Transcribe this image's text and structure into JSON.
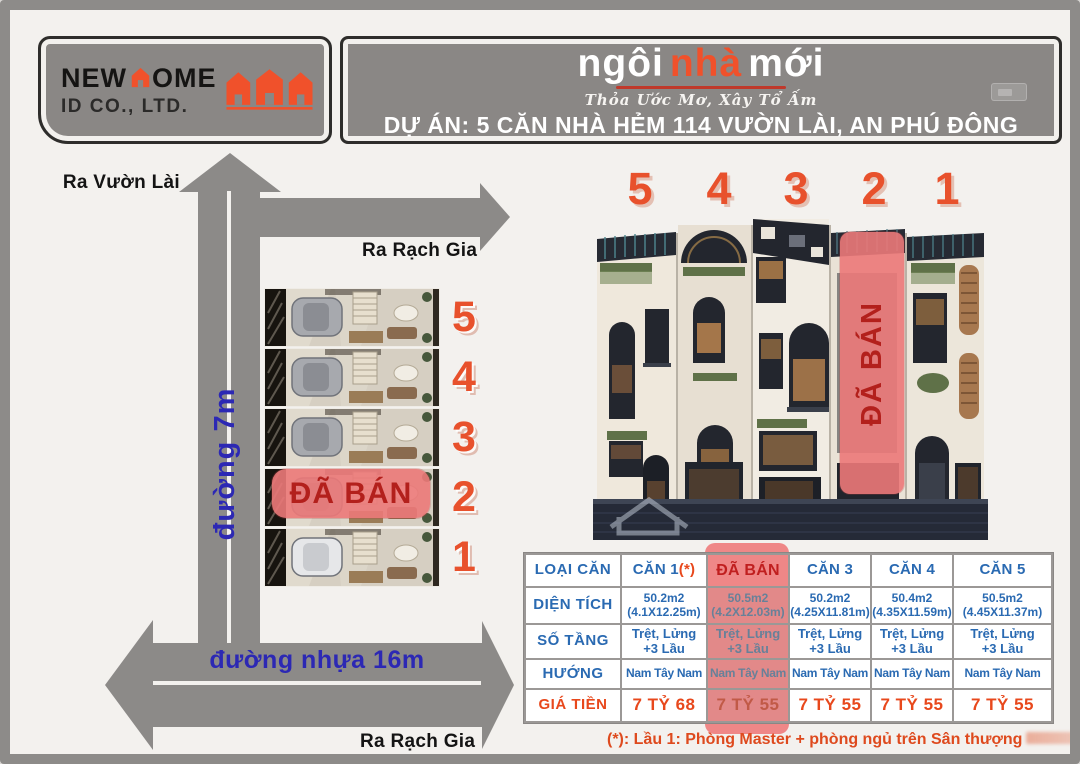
{
  "logo": {
    "brand_pre": "NEW",
    "brand_post": "OME",
    "brand_sub": "ID CO., LTD.",
    "house_icon_color": "#f0512b"
  },
  "header": {
    "title_pre": "ngôi",
    "title_mid": "nhà",
    "title_post": "mới",
    "tagline": "Thỏa Ước Mơ, Xây Tổ Ấm",
    "project_line": "DỰ ÁN:  5 CĂN NHÀ HẺM 114 VƯỜN LÀI, AN PHÚ ĐÔNG"
  },
  "map": {
    "exit_top": "Ra Vườn Lài",
    "exit_right": "Ra Rạch Gia",
    "exit_bottom": "Ra Rạch Gia",
    "road_vertical": "đường 7m",
    "road_horizontal": "đường nhựa 16m",
    "sold_label": "ĐÃ BÁN",
    "plans": [
      {
        "num": "5"
      },
      {
        "num": "4"
      },
      {
        "num": "3"
      },
      {
        "num": "2",
        "sold": true
      },
      {
        "num": "1"
      }
    ]
  },
  "render": {
    "unit_numbers": [
      "5",
      "4",
      "3",
      "2",
      "1"
    ],
    "sold_label": "ĐÃ BÁN"
  },
  "table": {
    "corner_label": "LOẠI CĂN",
    "col_headers": [
      "CĂN 1",
      "ĐÃ BÁN",
      "CĂN 3",
      "CĂN 4",
      "CĂN 5"
    ],
    "can1_suffix": "(*)",
    "sold_col_index": 1,
    "rows": [
      {
        "key": "dientich",
        "label": "DIỆN TÍCH",
        "cells": [
          [
            "50.2m2",
            "(4.1X12.25m)"
          ],
          [
            "50.5m2",
            "(4.2X12.03m)"
          ],
          [
            "50.2m2",
            "(4.25X11.81m)"
          ],
          [
            "50.4m2",
            "(4.35X11.59m)"
          ],
          [
            "50.5m2",
            "(4.45X11.37m)"
          ]
        ]
      },
      {
        "key": "sotang",
        "label": "SỐ TẦNG",
        "cells": [
          [
            "Trệt, Lửng",
            "+3 Lầu"
          ],
          [
            "Trệt, Lửng",
            "+3 Lầu"
          ],
          [
            "Trệt, Lửng",
            "+3 Lầu"
          ],
          [
            "Trệt, Lửng",
            "+3 Lầu"
          ],
          [
            "Trệt, Lửng",
            "+3 Lầu"
          ]
        ]
      },
      {
        "key": "huong",
        "label": "HƯỚNG",
        "cells": [
          [
            "Nam Tây Nam"
          ],
          [
            "Nam Tây Nam"
          ],
          [
            "Nam Tây Nam"
          ],
          [
            "Nam Tây Nam"
          ],
          [
            "Nam Tây Nam"
          ]
        ]
      },
      {
        "key": "gia",
        "label": "GIÁ TIỀN",
        "cells": [
          [
            "7 TỶ 68"
          ],
          [
            "7 TỶ 55"
          ],
          [
            "7 TỶ 55"
          ],
          [
            "7 TỶ 55"
          ],
          [
            "7 TỶ 55"
          ]
        ]
      }
    ]
  },
  "footnote": "(*): Lầu 1: Phòng Master + phòng ngủ trên Sân thượng",
  "colors": {
    "accent_orange": "#f0512b",
    "number_orange": "#e8512c",
    "road_gray": "#8c8a88",
    "road_text_blue": "#2c28b4",
    "table_blue": "#2a6ab2",
    "price_red": "#e8481c",
    "sold_pink": "#ef8787",
    "sold_red": "#b3201c"
  }
}
